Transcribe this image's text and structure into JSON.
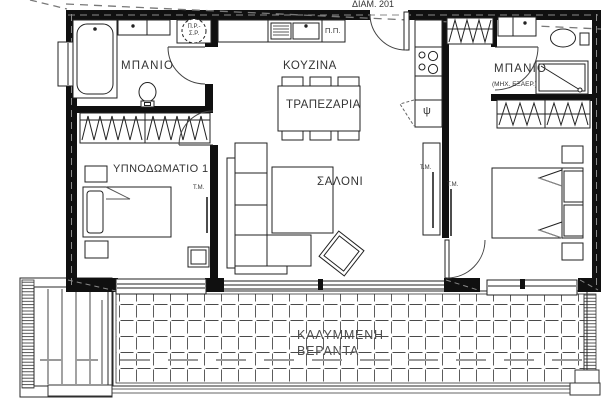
{
  "plan": {
    "title": "ΔΙΑΜ. 201",
    "rooms": {
      "bathroom_left": "ΜΠΑΝΙΟ",
      "kitchen": "ΚΟΥΖΙΝΑ",
      "dining": "ΤΡΑΠΕΖΑΡΙΑ",
      "living": "ΣΑΛΟΝΙ",
      "bedroom1": "ΥΠΝΟΔΩΜΑΤΙΟ 1",
      "bathroom_right": "ΜΠΑΝΙΟ",
      "bathroom_right_note": "(ΜΗΧ. ΕΞΑΕΡ.)",
      "veranda_line1": "ΚΑΛΥΜΜΕΝΗ",
      "veranda_line2": "ΒΕΡΑΝΤΑ"
    },
    "annotations": {
      "washer_dryer_top": "Π.Ρ.-",
      "washer_dryer_bottom": "Σ.Ρ.",
      "dishwasher": "Π.Π.",
      "fridge": "ψ",
      "fancoil": "Τ.Μ."
    },
    "colors": {
      "line": "#222222",
      "wall": "#101010",
      "roof_dash": "#787878",
      "joint": "#9a9a9a"
    }
  }
}
